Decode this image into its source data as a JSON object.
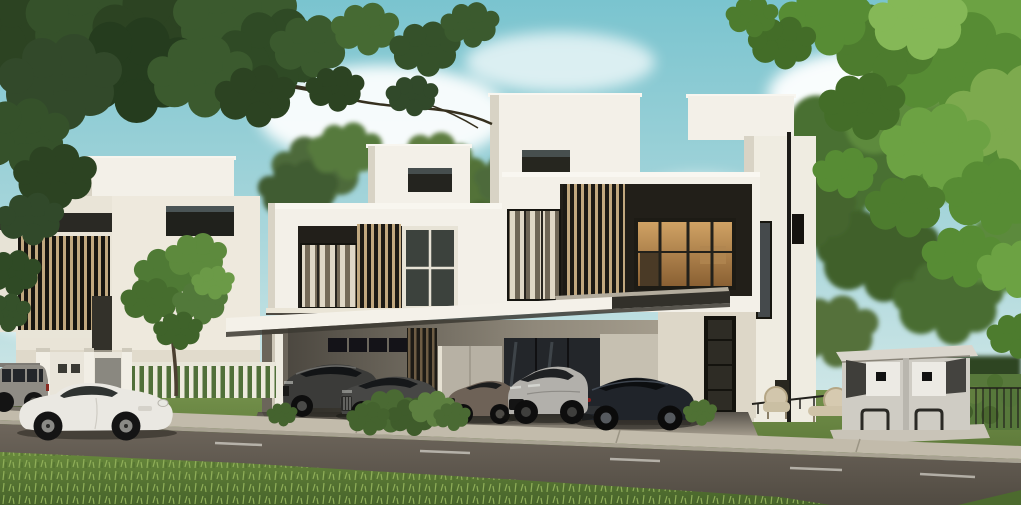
{
  "meta": {
    "description": "Photorealistic 3D exterior rendering of modern flat-roofed white duplex villas on a tree-lined street. Luxury cars are parked under the carport and a white sports coupe stands on the road. Overhanging tree branches frame the top corners, with a turquoise sky and soft clouds behind."
  },
  "scene": {
    "palette": {
      "sky_top": "#7ac4cf",
      "sky_mid": "#a8d6db",
      "sky_horizon": "#e7f1ee",
      "cloud": "#ffffff",
      "wall": "#f3f0e8",
      "wall_shade": "#d8d3c5",
      "fascia_dark": "#2a2924",
      "louver_wood": "#c1a87f",
      "glass_warm_top": "#d0a264",
      "glass_warm_bottom": "#8a6033",
      "canopy": "#f4f1e9",
      "screen_wall": "#b7b1a4",
      "cabinet_body": "#cfccc4",
      "road_top": "#6e665c",
      "road_bottom": "#514b42",
      "sidewalk": "#c2bbab",
      "curb": "#a8a292",
      "lane_marking": "#eceae2",
      "lawn_top": "#74914b",
      "lawn_bottom": "#5a7637",
      "verge_top": "#68893c",
      "verge_bottom": "#46622a",
      "hedge": "#57783b",
      "foliage_dark": "#32492a",
      "foliage_bright": "#7daa4e"
    },
    "vehicles": [
      {
        "name": "grey-offroad-suv",
        "color": "#8f8c85"
      },
      {
        "name": "white-sports-coupe",
        "color": "#eae8e2"
      },
      {
        "name": "dark-grey-crossover-suv",
        "color": "#3b3b39"
      },
      {
        "name": "dark-grey-grand-tourer",
        "color": "#474745"
      },
      {
        "name": "bronze-roadster",
        "color": "#6e6257"
      },
      {
        "name": "silver-performance-suv",
        "color": "#b2b0ab"
      },
      {
        "name": "black-luxury-coupe",
        "color": "#20242a"
      }
    ],
    "objects": [
      "sky-with-clouds",
      "overhanging-tree-left",
      "overhanging-tree-right",
      "background-trees",
      "left-villa",
      "main-duplex-villa",
      "rooftop-boxes",
      "wood-louver-screens",
      "lit-interior-window",
      "carport-canopy",
      "entrance-door",
      "partition-screen",
      "entry-gate",
      "white-picket-fence",
      "front-yard-tree",
      "garden-chairs",
      "garden-railing",
      "trimmed-hedge",
      "utility-cabinets",
      "front-lawn",
      "sidewalk",
      "asphalt-road",
      "lane-markings",
      "grass-verge",
      "parked-cars",
      "shrubs"
    ]
  }
}
